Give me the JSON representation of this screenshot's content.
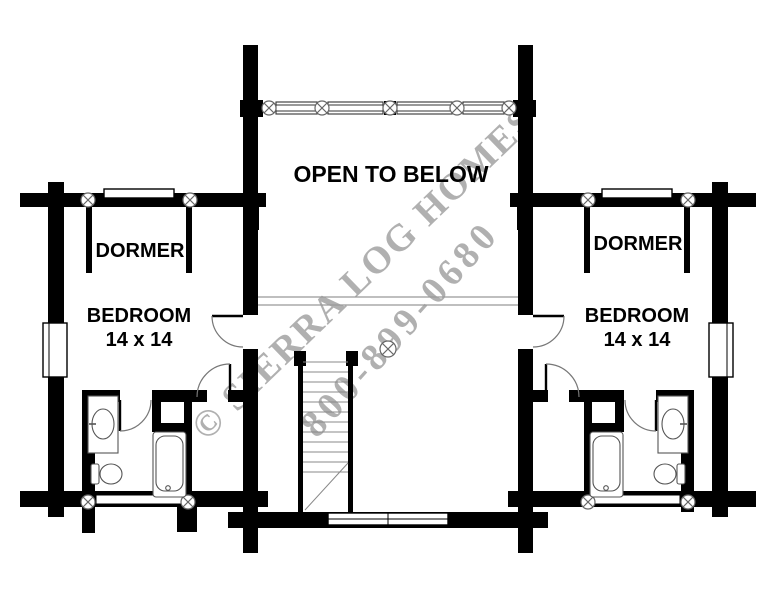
{
  "plan": {
    "open_to_below": "OPEN TO BELOW",
    "dormer_left": "DORMER",
    "dormer_right": "DORMER",
    "bedroom_left": {
      "name": "BEDROOM",
      "size": "14 x 14"
    },
    "bedroom_right": {
      "name": "BEDROOM",
      "size": "14 x 14"
    }
  },
  "watermark": {
    "line1": "© SIERRA LOG HOMES",
    "line2": "800-899-0680",
    "color": "#b0b0b0"
  },
  "colors": {
    "wall": "#000000",
    "background": "#ffffff",
    "fixture_line": "#555555",
    "tread_line": "#888888"
  }
}
